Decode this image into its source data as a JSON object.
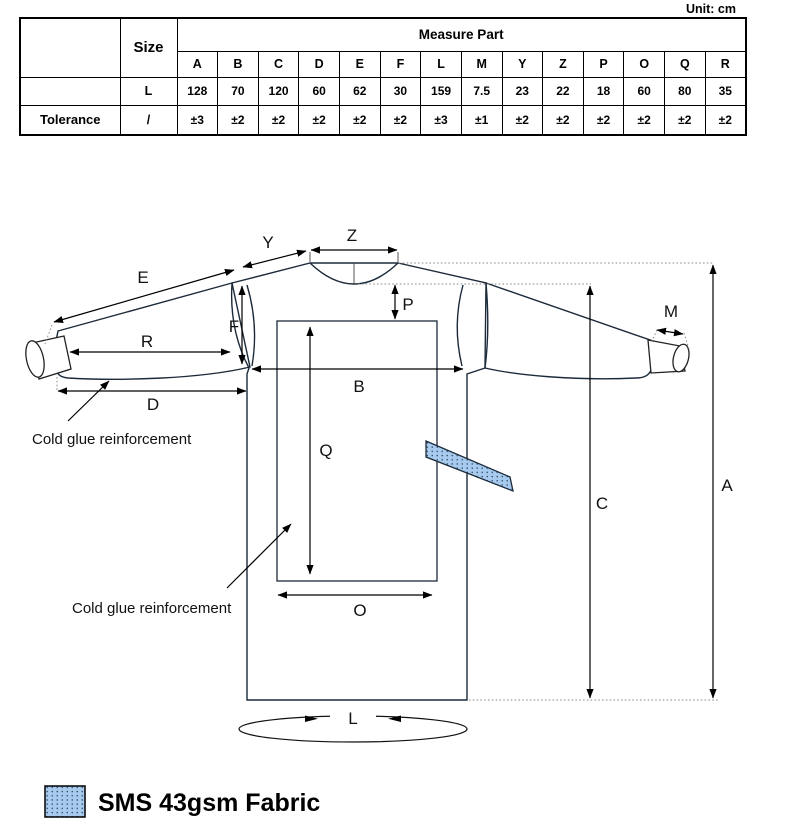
{
  "unit_label": "Unit: cm",
  "table": {
    "measure_part_header": "Measure Part",
    "size_header": "Size",
    "tolerance_label": "Tolerance",
    "columns": [
      "A",
      "B",
      "C",
      "D",
      "E",
      "F",
      "L",
      "M",
      "Y",
      "Z",
      "P",
      "O",
      "Q",
      "R"
    ],
    "size_row_label": "L",
    "size_values": [
      "128",
      "70",
      "120",
      "60",
      "62",
      "30",
      "159",
      "7.5",
      "23",
      "22",
      "18",
      "60",
      "80",
      "35"
    ],
    "tolerance_row_label": "/",
    "tolerance_values": [
      "±3",
      "±2",
      "±2",
      "±2",
      "±2",
      "±2",
      "±3",
      "±1",
      "±2",
      "±2",
      "±2",
      "±2",
      "±2",
      "±2"
    ]
  },
  "diagram": {
    "labels": {
      "A": "A",
      "B": "B",
      "C": "C",
      "D": "D",
      "E": "E",
      "F": "F",
      "L": "L",
      "M": "M",
      "O": "O",
      "P": "P",
      "Q": "Q",
      "R": "R",
      "Y": "Y",
      "Z": "Z"
    },
    "annotations": {
      "cold_glue_top": "Cold glue reinforcement",
      "cold_glue_mid": "Cold glue reinforcement"
    },
    "colors": {
      "body_fabric": "#a6cbee",
      "body_dot": "#2e4157",
      "sleeve_fabric": "#cde8e3",
      "sleeve_dot": "#ffffff",
      "outline": "#1c2b3a"
    }
  },
  "legend": {
    "fabric_label": "SMS 43gsm Fabric"
  }
}
